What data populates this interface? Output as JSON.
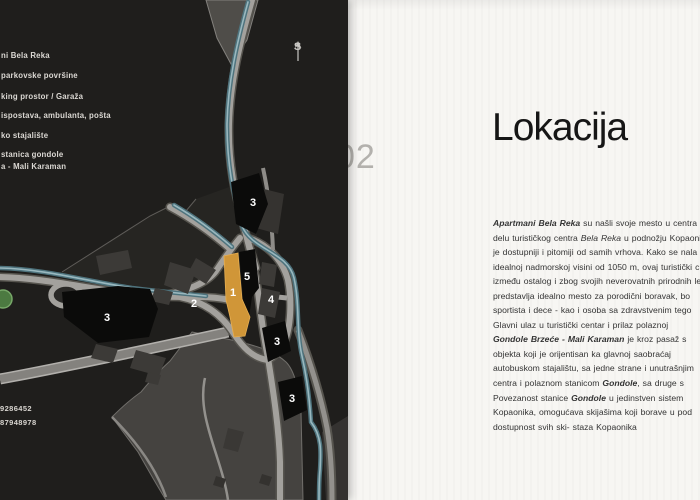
{
  "map": {
    "legend_lines": [
      "ni Bela Reka",
      "parkovske površine",
      "king prostor / Garaža",
      "ispostava, ambulanta, pošta",
      "ko stajalište",
      "stanica gondole",
      "a - Mali Karaman"
    ],
    "compass_label": "S",
    "zone_labels": [
      "3",
      "5",
      "1",
      "2",
      "4",
      "3",
      "3",
      "3"
    ],
    "phone_lines": [
      "9286452",
      "87948978"
    ],
    "colors": {
      "map_background": "#1f1e1c",
      "road": "#a3a19d",
      "river": "#4e737d",
      "highlight_building": "#d09638",
      "zone_fill": "#0b0b0a",
      "open_area": "#454340",
      "legend_text": "#dbd8d3"
    }
  },
  "panel": {
    "page_number": "02",
    "title": "Lokacija",
    "paragraph_lines": [
      [
        {
          "t": "Apartmani Bela Reka",
          "b": true,
          "i": true
        },
        {
          "t": " su našli svoje mesto u centra"
        }
      ],
      [
        {
          "t": "delu turističkog centra "
        },
        {
          "t": "Bela Reka",
          "i": true
        },
        {
          "t": " u podnožju Kopaonik"
        }
      ],
      [
        {
          "t": "je dostupniji i pitomiji od samih vrhova. Kako se nala"
        }
      ],
      [
        {
          "t": "idealnoj nadmorskoj visini od 1050 m, ovaj turistički c"
        }
      ],
      [
        {
          "t": "između ostalog i zbog svojih neverovatnih prirodnih le"
        }
      ],
      [
        {
          "t": "predstavlja idealno mesto za porodični boravak, bo"
        }
      ],
      [
        {
          "t": "sportista i dece -  kao i osoba sa zdravstvenim tego"
        }
      ],
      [
        {
          "t": "Glavni ulaz u turistički centar i prilaz polaznoj"
        }
      ],
      [
        {
          "t": "Gondole Brzeće - Mali Karaman",
          "b": true,
          "i": true
        },
        {
          "t": " je kroz pasaž s"
        }
      ],
      [
        {
          "t": "objekta koji je orijentisan ka glavnoj saobraćaj"
        }
      ],
      [
        {
          "t": "autobuskom stajalištu, sa jedne strane i unutrašnjim"
        }
      ],
      [
        {
          "t": "centra i polaznom stanicom "
        },
        {
          "t": "Gondole",
          "b": true,
          "i": true
        },
        {
          "t": ", sa druge s"
        }
      ],
      [
        {
          "t": "Povezanost stanice "
        },
        {
          "t": "Gondole",
          "b": true,
          "i": true
        },
        {
          "t": " u jedinstven sistem"
        }
      ],
      [
        {
          "t": "Kopaonika, omogućava skijašima koji borave u pod"
        }
      ],
      [
        {
          "t": "dostupnost svih ski- staza Kopaonika"
        }
      ]
    ],
    "colors": {
      "panel_background": "#f7f6f3",
      "title": "#161616",
      "body_text": "#343434",
      "page_number": "#b3b1ad"
    }
  }
}
